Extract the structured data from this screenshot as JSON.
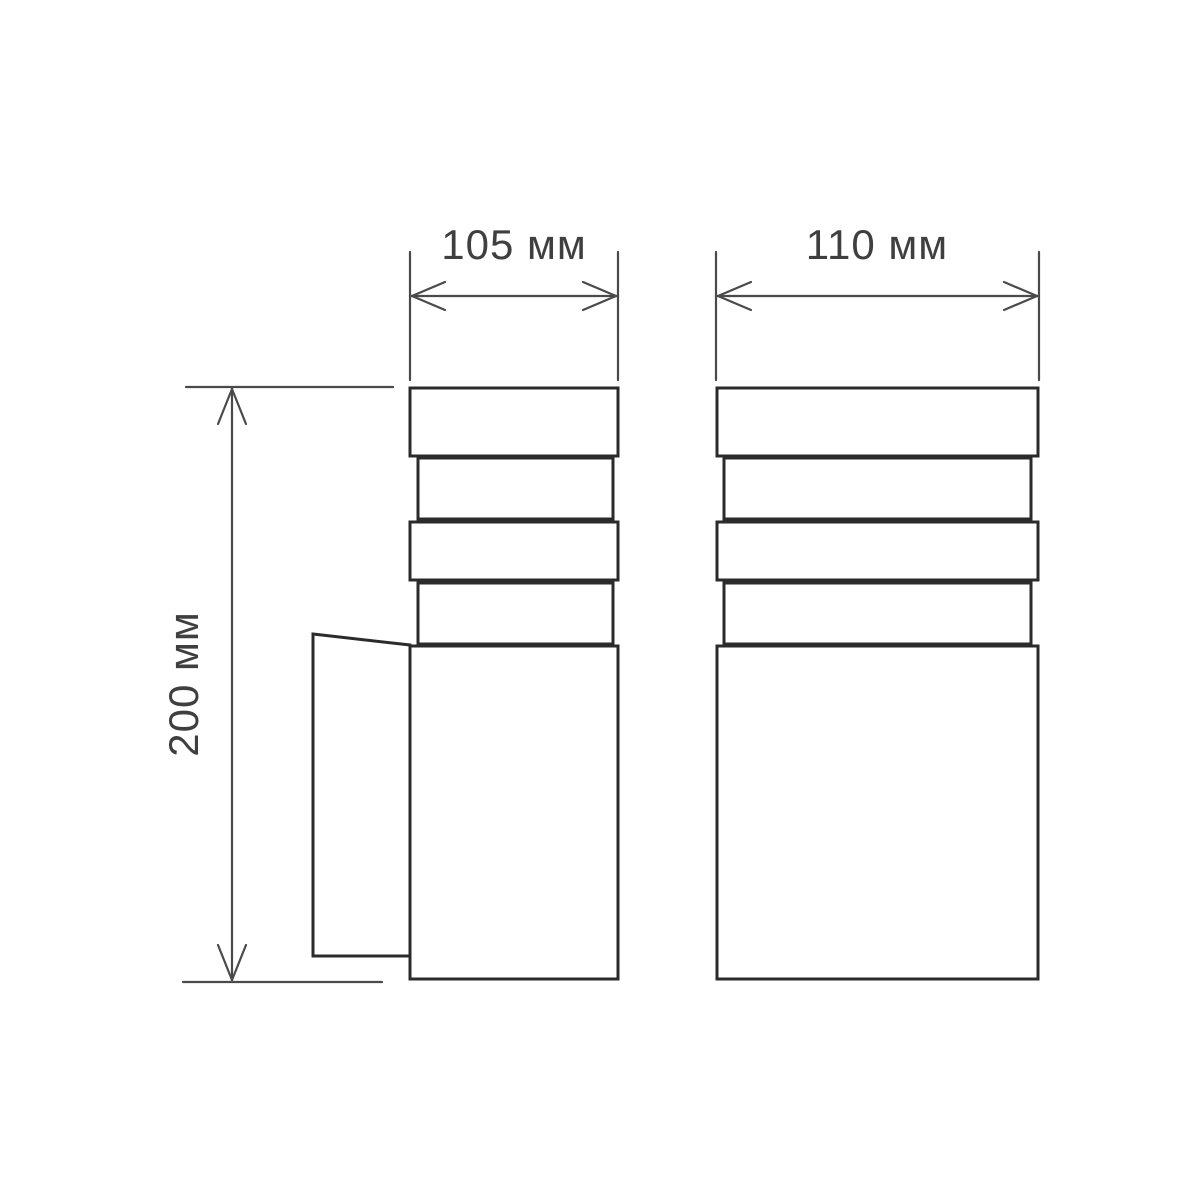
{
  "drawing": {
    "dimensions": {
      "front_width": "105 мм",
      "side_width": "110 мм",
      "height": "200 мм"
    },
    "colors": {
      "outline": "#2b2b2b",
      "dimension_lines": "#4a4a4a",
      "label_text": "#3f3f3f",
      "background": "#ffffff"
    }
  }
}
